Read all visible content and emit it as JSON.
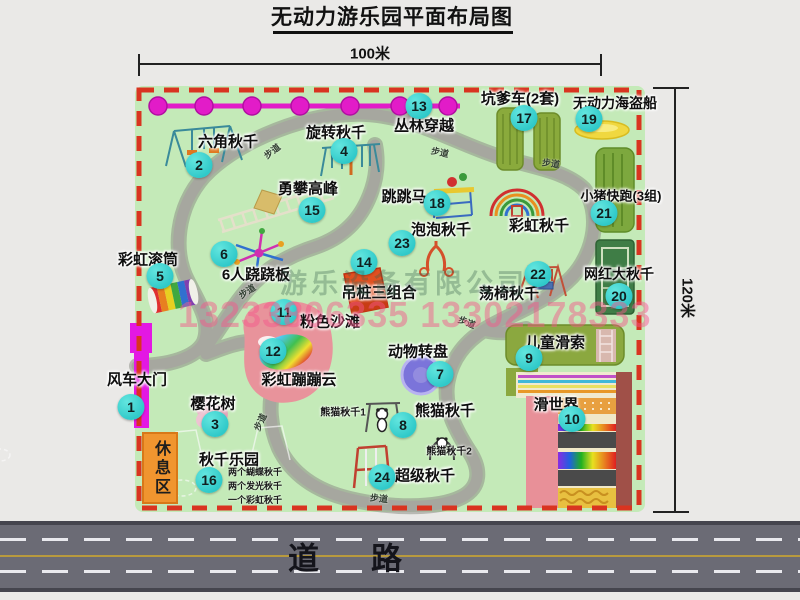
{
  "title": "无动力游乐园平面布局图",
  "dimensions": {
    "width_label": "100米",
    "height_label": "120米"
  },
  "road": {
    "label": "道路"
  },
  "watermark": {
    "company": "游乐设备有限公司",
    "phone": "13233806335 13302178333"
  },
  "rest_area": {
    "label": "休息区"
  },
  "trail_label": "步道",
  "trails": [
    {
      "x": 272,
      "y": 151,
      "r": -38
    },
    {
      "x": 440,
      "y": 152,
      "r": 12
    },
    {
      "x": 551,
      "y": 163,
      "r": 8
    },
    {
      "x": 247,
      "y": 291,
      "r": -33
    },
    {
      "x": 467,
      "y": 322,
      "r": 22
    },
    {
      "x": 260,
      "y": 422,
      "r": -65
    },
    {
      "x": 379,
      "y": 498,
      "r": 6
    }
  ],
  "features": [
    {
      "num": "1",
      "label": "风车大门",
      "lx": 137,
      "ly": 379,
      "bx": 131,
      "by": 407
    },
    {
      "num": "2",
      "label": "六角秋千",
      "lx": 228,
      "ly": 141,
      "bx": 199,
      "by": 165
    },
    {
      "num": "3",
      "label": "樱花树",
      "lx": 213,
      "ly": 403,
      "bx": 215,
      "by": 424
    },
    {
      "num": "4",
      "label": "旋转秋千",
      "lx": 336,
      "ly": 132,
      "bx": 344,
      "by": 151
    },
    {
      "num": "5",
      "label": "彩虹滚筒",
      "lx": 148,
      "ly": 259,
      "bx": 160,
      "by": 276
    },
    {
      "num": "6",
      "label": "6人跷跷板",
      "lx": 256,
      "ly": 274,
      "bx": 224,
      "by": 254
    },
    {
      "num": "7",
      "label": "动物转盘",
      "lx": 418,
      "ly": 351,
      "bx": 440,
      "by": 374
    },
    {
      "num": "8",
      "label": "熊猫秋千",
      "lx": 445,
      "ly": 410,
      "bx": 403,
      "by": 425
    },
    {
      "num": "9",
      "label": "儿童滑索",
      "lx": 555,
      "ly": 342,
      "bx": 529,
      "by": 358
    },
    {
      "num": "10",
      "label": "滑世界",
      "lx": 556,
      "ly": 404,
      "bx": 572,
      "by": 419
    },
    {
      "num": "11",
      "label": "粉色沙滩",
      "lx": 330,
      "ly": 321,
      "bx": 284,
      "by": 312
    },
    {
      "num": "12",
      "label": "彩虹蹦蹦云",
      "lx": 299,
      "ly": 379,
      "bx": 273,
      "by": 351
    },
    {
      "num": "13",
      "label": "丛林穿越",
      "lx": 424,
      "ly": 125,
      "bx": 419,
      "by": 106
    },
    {
      "num": "14",
      "label": "吊桩三组合",
      "lx": 379,
      "ly": 292,
      "bx": 364,
      "by": 262
    },
    {
      "num": "15",
      "label": "勇攀高峰",
      "lx": 308,
      "ly": 188,
      "bx": 312,
      "by": 210
    },
    {
      "num": "16",
      "label": "秋千乐园",
      "lx": 229,
      "ly": 459,
      "bx": 209,
      "by": 480
    },
    {
      "num": "17",
      "label": "坑爹车(2套)",
      "lx": 520,
      "ly": 98,
      "bx": 524,
      "by": 118
    },
    {
      "num": "18",
      "label": "跳跳马",
      "lx": 404,
      "ly": 196,
      "bx": 437,
      "by": 203
    },
    {
      "num": "19",
      "label": "无动力海盗船",
      "lx": 615,
      "ly": 103,
      "bx": 589,
      "by": 119,
      "fs": 14
    },
    {
      "num": "20",
      "label": "网红大秋千",
      "lx": 619,
      "ly": 274,
      "bx": 619,
      "by": 296,
      "fs": 14
    },
    {
      "num": "21",
      "label": "小猪快跑(3组)",
      "lx": 621,
      "ly": 195,
      "bx": 604,
      "by": 213,
      "fs": 13
    },
    {
      "num": "22",
      "label": "荡椅秋千",
      "lx": 509,
      "ly": 293,
      "bx": 538,
      "by": 274
    },
    {
      "num": "23",
      "label": "泡泡秋千",
      "lx": 441,
      "ly": 229,
      "bx": 402,
      "by": 243
    },
    {
      "num": "24",
      "label": "超级秋千",
      "lx": 425,
      "ly": 475,
      "bx": 382,
      "by": 477
    },
    {
      "num": "",
      "label": "彩虹秋千",
      "lx": 539,
      "ly": 225
    }
  ],
  "sub_labels": [
    {
      "text": "熊猫秋千1",
      "x": 343,
      "y": 411
    },
    {
      "text": "熊猫秋千2",
      "x": 449,
      "y": 450
    }
  ],
  "swing_park_notes": [
    "两个蝴蝶秋千",
    "两个发光秋千",
    "一个彩虹秋千"
  ],
  "colors": {
    "map_green": "#c4eab8",
    "border_red": "#d93420",
    "badge": "#2fc9c9",
    "zipline": "#e21cc8",
    "gate": "#e318e3",
    "rest_area": "#f0952f",
    "road": "#6b6b75"
  }
}
